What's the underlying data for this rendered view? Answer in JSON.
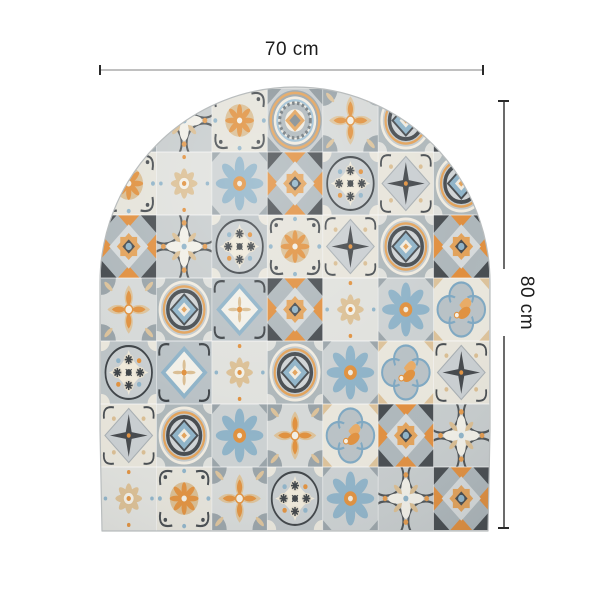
{
  "dimensions": {
    "width_label": "70 cm",
    "height_label": "80 cm"
  },
  "panel": {
    "description": "arched patchwork panel of Mediterranean azulejo cement tiles",
    "shape": "arch",
    "grid": {
      "cols": 7,
      "rows": 7
    },
    "tile_grid": [
      [
        "M7",
        "M4",
        "M11",
        "M1",
        "M12",
        "M10",
        "M2"
      ],
      [
        "M11",
        "M8",
        "M7",
        "M2",
        "M9",
        "M5",
        "M10"
      ],
      [
        "M2",
        "M4",
        "M9",
        "M11",
        "M5",
        "M10",
        "M2"
      ],
      [
        "M12",
        "M10",
        "M6",
        "M2",
        "M8",
        "M7",
        "M3"
      ],
      [
        "M9",
        "M6",
        "M8",
        "M10",
        "M7",
        "M3",
        "M5"
      ],
      [
        "M5",
        "M10",
        "M7",
        "M12",
        "M3",
        "M2",
        "M4"
      ],
      [
        "M8",
        "M11",
        "M12",
        "M9",
        "M7",
        "M4",
        "M2"
      ]
    ],
    "motif_names": {
      "M1": "gear-medallion",
      "M2": "kaleidoscope-star",
      "M3": "quatrefoil-bee",
      "M4": "ring-cross-flower",
      "M5": "diamond-dark-star",
      "M6": "white-diamond",
      "M7": "blue-daisy",
      "M8": "tan-star-flower",
      "M9": "snowflake-medallion",
      "M10": "circle-diamond-medallion",
      "M11": "scroll-rosette",
      "M12": "petal-cross"
    },
    "palette": {
      "orange": "#e0913f",
      "tan": "#d9bd94",
      "steel_blue": "#8fb3c8",
      "charcoal": "#474c50",
      "light_gray": "#d6d9d8",
      "mid_gray": "#aeb7bb",
      "cream": "#f0ebe0"
    }
  },
  "annotation": {
    "line_color": "#c0c0c0",
    "tick_color": "#2a2a2a",
    "text_color": "#1c1c1c"
  }
}
